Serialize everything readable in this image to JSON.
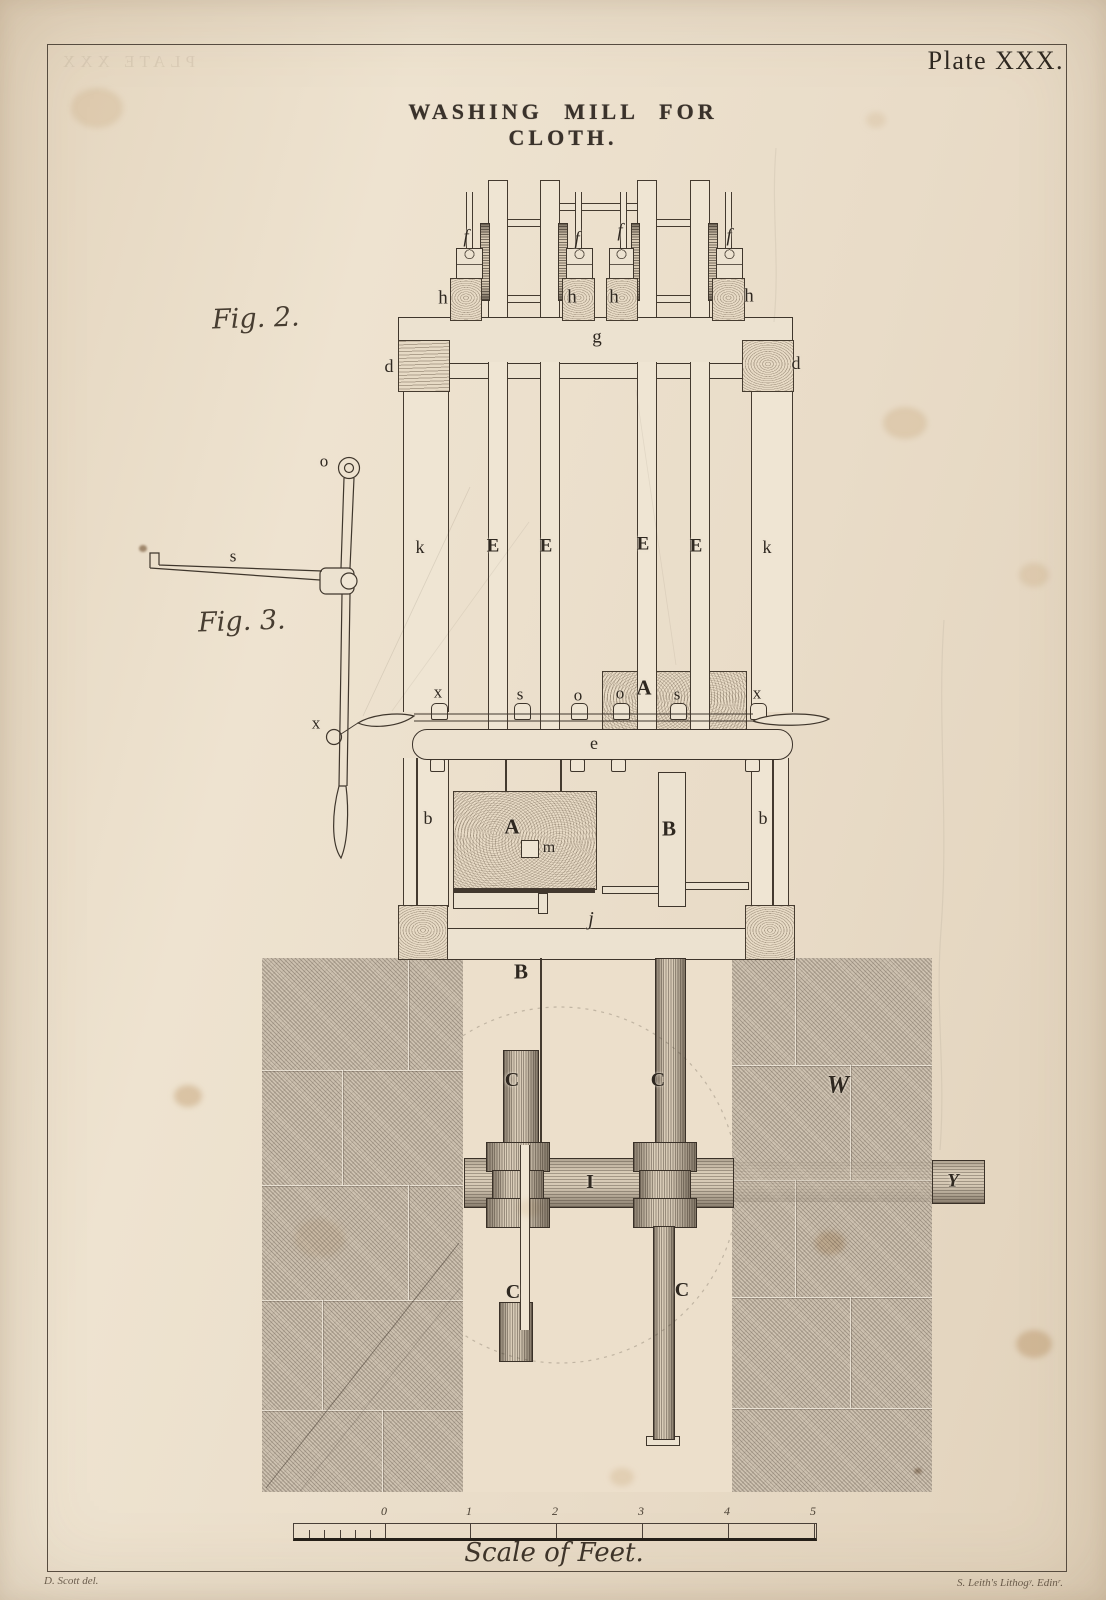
{
  "plate_label": "Plate XXX.",
  "title": "WASHING MILL FOR CLOTH.",
  "ghost_text": "PLATE XXX",
  "figures": {
    "fig2_caption": "Fig. 2.",
    "fig3_caption": "Fig. 3."
  },
  "part_labels": [
    {
      "t": "f",
      "x": 466,
      "y": 237,
      "s": 19,
      "i": 1
    },
    {
      "t": "f",
      "x": 577,
      "y": 239,
      "s": 19,
      "i": 1
    },
    {
      "t": "f",
      "x": 620,
      "y": 231,
      "s": 19,
      "i": 1
    },
    {
      "t": "f",
      "x": 729,
      "y": 236,
      "s": 19,
      "i": 1
    },
    {
      "t": "h",
      "x": 443,
      "y": 298,
      "s": 19,
      "i": 0
    },
    {
      "t": "h",
      "x": 572,
      "y": 297,
      "s": 19,
      "i": 0
    },
    {
      "t": "h",
      "x": 614,
      "y": 297,
      "s": 19,
      "i": 0
    },
    {
      "t": "h",
      "x": 749,
      "y": 296,
      "s": 19,
      "i": 0
    },
    {
      "t": "g",
      "x": 597,
      "y": 337,
      "s": 19,
      "i": 0
    },
    {
      "t": "d",
      "x": 389,
      "y": 366,
      "s": 18,
      "i": 0
    },
    {
      "t": "d",
      "x": 796,
      "y": 363,
      "s": 18,
      "i": 0
    },
    {
      "t": "k",
      "x": 420,
      "y": 547,
      "s": 18,
      "i": 0
    },
    {
      "t": "E",
      "x": 493,
      "y": 546,
      "s": 19,
      "i": 0
    },
    {
      "t": "E",
      "x": 546,
      "y": 546,
      "s": 19,
      "i": 0
    },
    {
      "t": "E",
      "x": 643,
      "y": 544,
      "s": 19,
      "i": 0
    },
    {
      "t": "E",
      "x": 696,
      "y": 546,
      "s": 19,
      "i": 0
    },
    {
      "t": "k",
      "x": 767,
      "y": 547,
      "s": 18,
      "i": 0
    },
    {
      "t": "o",
      "x": 324,
      "y": 461,
      "s": 17,
      "i": 0
    },
    {
      "t": "s",
      "x": 233,
      "y": 556,
      "s": 17,
      "i": 0
    },
    {
      "t": "x",
      "x": 316,
      "y": 723,
      "s": 17,
      "i": 0
    },
    {
      "t": "x",
      "x": 438,
      "y": 692,
      "s": 17,
      "i": 0
    },
    {
      "t": "s",
      "x": 520,
      "y": 694,
      "s": 17,
      "i": 0
    },
    {
      "t": "o",
      "x": 578,
      "y": 695,
      "s": 17,
      "i": 0
    },
    {
      "t": "o",
      "x": 620,
      "y": 693,
      "s": 17,
      "i": 0
    },
    {
      "t": "A",
      "x": 644,
      "y": 688,
      "s": 21,
      "i": 0
    },
    {
      "t": "s",
      "x": 677,
      "y": 694,
      "s": 17,
      "i": 0
    },
    {
      "t": "x",
      "x": 757,
      "y": 693,
      "s": 17,
      "i": 0
    },
    {
      "t": "e",
      "x": 594,
      "y": 743,
      "s": 18,
      "i": 0
    },
    {
      "t": "b",
      "x": 428,
      "y": 818,
      "s": 18,
      "i": 0
    },
    {
      "t": "A",
      "x": 512,
      "y": 827,
      "s": 21,
      "i": 0
    },
    {
      "t": "m",
      "x": 549,
      "y": 848,
      "s": 16,
      "i": 0
    },
    {
      "t": "B",
      "x": 669,
      "y": 829,
      "s": 21,
      "i": 0
    },
    {
      "t": "b",
      "x": 763,
      "y": 818,
      "s": 18,
      "i": 0
    },
    {
      "t": "j",
      "x": 591,
      "y": 919,
      "s": 20,
      "i": 1
    },
    {
      "t": "B",
      "x": 521,
      "y": 972,
      "s": 21,
      "i": 0
    },
    {
      "t": "C",
      "x": 512,
      "y": 1080,
      "s": 20,
      "i": 0
    },
    {
      "t": "C",
      "x": 658,
      "y": 1080,
      "s": 20,
      "i": 0
    },
    {
      "t": "I",
      "x": 590,
      "y": 1182,
      "s": 20,
      "i": 0
    },
    {
      "t": "W",
      "x": 838,
      "y": 1085,
      "s": 25,
      "i": 1
    },
    {
      "t": "Y",
      "x": 953,
      "y": 1181,
      "s": 19,
      "i": 1
    },
    {
      "t": "C",
      "x": 513,
      "y": 1292,
      "s": 20,
      "i": 0
    },
    {
      "t": "C",
      "x": 682,
      "y": 1290,
      "s": 20,
      "i": 0
    }
  ],
  "scale_bar": {
    "caption": "Scale of Feet.",
    "ticks": [
      {
        "t": "0",
        "x": 384
      },
      {
        "t": "1",
        "x": 469
      },
      {
        "t": "2",
        "x": 555
      },
      {
        "t": "3",
        "x": 641
      },
      {
        "t": "4",
        "x": 727
      },
      {
        "t": "5",
        "x": 813
      }
    ]
  },
  "credits": {
    "artist": "D. Scott del.",
    "lithographer": "S. Leith's Lithogʸ. Edinʳ."
  },
  "colors": {
    "paper": "#e9dcc8",
    "ink": "#3a322b",
    "wall": "#cdc1b0",
    "wood_line": "#5f5244"
  }
}
